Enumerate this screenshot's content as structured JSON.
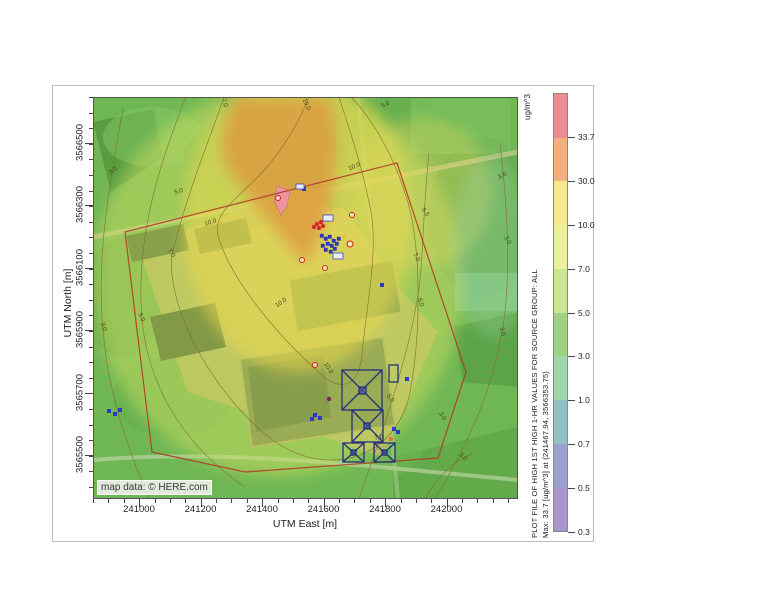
{
  "figure": {
    "x_axis": {
      "label": "UTM East [m]",
      "ticks": [
        "241000",
        "241200",
        "241400",
        "241600",
        "241800",
        "242000"
      ]
    },
    "y_axis": {
      "label": "UTM North [m]",
      "ticks": [
        "3566500",
        "3566300",
        "3566100",
        "3565900",
        "3565700",
        "3565500"
      ]
    },
    "colorbar": {
      "units_label": "ug/m^3",
      "tick_labels": [
        "33.7",
        "30.0",
        "10.0",
        "7.0",
        "5.0",
        "3.0",
        "1.0",
        "0.7",
        "0.5",
        "0.3"
      ],
      "segment_colors": [
        "#ed8d92",
        "#f3b07e",
        "#f8e88e",
        "#e9f19a",
        "#c9e593",
        "#9dd37f",
        "#9cd6ab",
        "#8fc1c5",
        "#9c9fd1",
        "#ab93cc"
      ]
    },
    "side_titles": {
      "line1": "PLOT FILE OF HIGH 1ST HIGH 1-HR VALUES FOR SOURCE GROUP: ALL",
      "line2": "Max:  33.7  [ug/m^3]  at  (241467.94, 3566353.75)"
    },
    "map": {
      "attribution": "map data: © HERE.com",
      "contour_labels": [
        {
          "t": "10.0",
          "x": 212,
          "y": 8,
          "r": 65
        },
        {
          "t": "10.0",
          "x": 262,
          "y": 71,
          "r": -25
        },
        {
          "t": "10.0",
          "x": 118,
          "y": 127,
          "r": -18
        },
        {
          "t": "10.0",
          "x": 189,
          "y": 207,
          "r": -35
        },
        {
          "t": "10.0",
          "x": 234,
          "y": 272,
          "r": 58
        },
        {
          "t": "7.0",
          "x": 130,
          "y": 6,
          "r": 75
        },
        {
          "t": "7.0",
          "x": 77,
          "y": 157,
          "r": 55
        },
        {
          "t": "7.0",
          "x": 322,
          "y": 161,
          "r": 62
        },
        {
          "t": "7.0",
          "x": 286,
          "y": 342,
          "r": -15
        },
        {
          "t": "5.0",
          "x": 293,
          "y": 9,
          "r": -25
        },
        {
          "t": "5.0",
          "x": 86,
          "y": 96,
          "r": -15
        },
        {
          "t": "5.0",
          "x": 47,
          "y": 221,
          "r": 65
        },
        {
          "t": "5.0",
          "x": 331,
          "y": 116,
          "r": 55
        },
        {
          "t": "5.0",
          "x": 326,
          "y": 206,
          "r": 70
        },
        {
          "t": "5.0",
          "x": 296,
          "y": 302,
          "r": 55
        },
        {
          "t": "3.0",
          "x": 21,
          "y": 75,
          "r": -35
        },
        {
          "t": "3.0",
          "x": 9,
          "y": 230,
          "r": 75
        },
        {
          "t": "3.0",
          "x": 410,
          "y": 80,
          "r": -30
        },
        {
          "t": "3.0",
          "x": 413,
          "y": 144,
          "r": 60
        },
        {
          "t": "3.0",
          "x": 408,
          "y": 235,
          "r": 75
        },
        {
          "t": "3.0",
          "x": 348,
          "y": 320,
          "r": 60
        },
        {
          "t": "3.0",
          "x": 369,
          "y": 361,
          "r": 42
        }
      ]
    }
  },
  "chart_data": {
    "type": "heatmap",
    "subtype": "contour-map-overlay",
    "title": "PLOT FILE OF HIGH 1ST HIGH 1-HR VALUES FOR SOURCE GROUP: ALL",
    "units": "ug/m^3",
    "xlabel": "UTM East [m]",
    "ylabel": "UTM North [m]",
    "x_ticks": [
      241000,
      241200,
      241400,
      241600,
      241800,
      242000
    ],
    "y_ticks": [
      3566500,
      3566300,
      3566100,
      3565900,
      3565700,
      3565500
    ],
    "contour_levels": [
      0.3,
      0.5,
      0.7,
      1.0,
      3.0,
      5.0,
      7.0,
      10.0,
      30.0,
      33.7
    ],
    "level_colors_low_to_high": [
      "#ab93cc",
      "#9c9fd1",
      "#8fc1c5",
      "#9cd6ab",
      "#9dd37f",
      "#c9e593",
      "#e9f19a",
      "#f8e88e",
      "#f3b07e",
      "#ed8d92"
    ],
    "max_value": {
      "value": 33.7,
      "units": "ug/m^3",
      "utm_east": 241467.94,
      "utm_north": 3566353.75
    },
    "basemap_attribution": "map data: © HERE.com",
    "legend_position": "right",
    "grid": false
  }
}
